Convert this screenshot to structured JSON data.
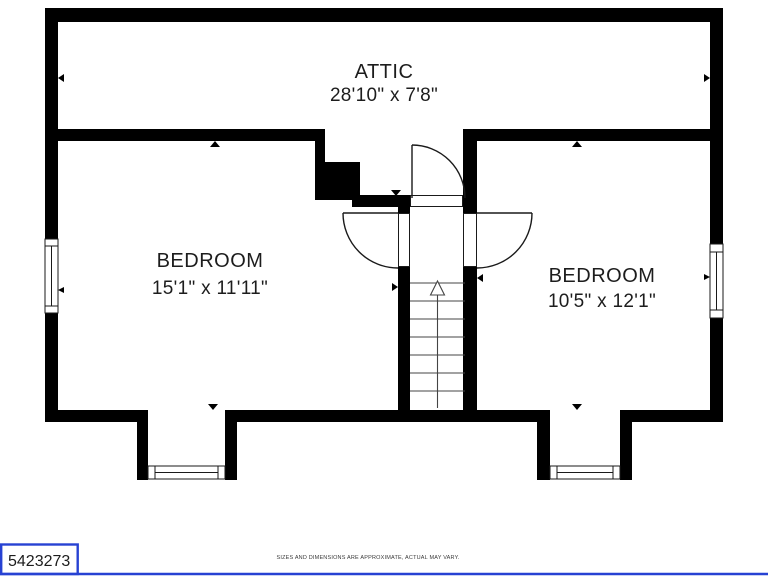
{
  "plan": {
    "title": "attic-level-floor-plan",
    "rooms": [
      {
        "name": "ATTIC",
        "dimensions": "28'10\" x 7'8\""
      },
      {
        "name": "BEDROOM",
        "dimensions": "15'1\" x 11'11\""
      },
      {
        "name": "BEDROOM",
        "dimensions": "10'5\" x 12'1\""
      }
    ],
    "features": {
      "stairs_direction": "up",
      "door_count": 3,
      "window_count": 4
    }
  },
  "footer": {
    "listing_id": "5423273",
    "disclaimer": "SIZES AND DIMENSIONS ARE APPROXIMATE, ACTUAL MAY VARY."
  },
  "colors": {
    "wall": "#000000",
    "line": "#1a1a1a",
    "stair_line": "#444444",
    "text": "#1d1d1d",
    "disclaimer_text": "#3a3a3a",
    "accent_blue": "#2742d3",
    "background": "#ffffff"
  }
}
